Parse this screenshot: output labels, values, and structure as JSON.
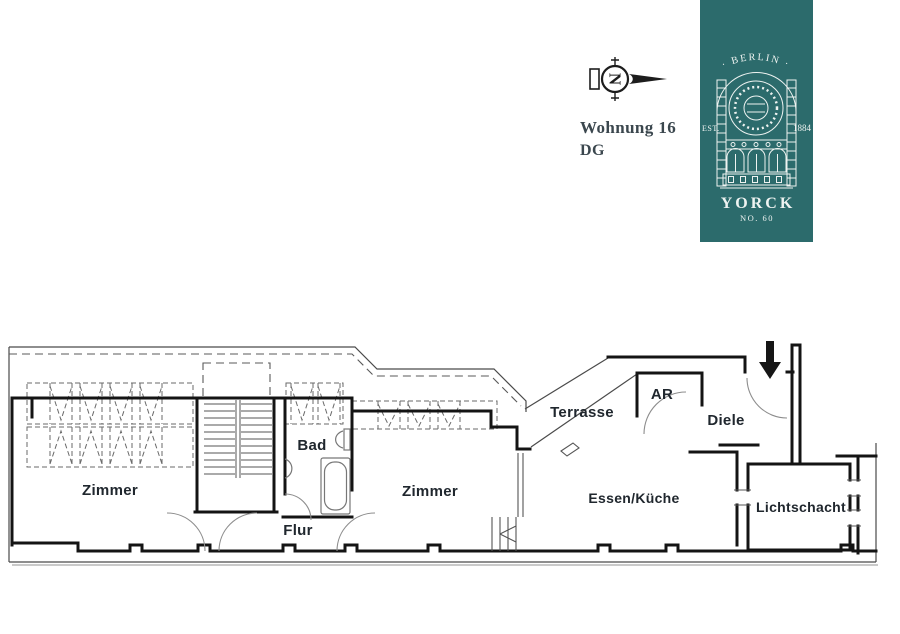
{
  "header": {
    "apartment_label": "Wohnung 16",
    "floor_label": "DG",
    "compass_letter": "N"
  },
  "badge": {
    "city": "· BERLIN ·",
    "est_label": "EST.",
    "year": "1884",
    "house_name": "YORCK",
    "house_number": "NO. 60",
    "background_color": "#2c6b6c",
    "foreground_color": "#eef3f1"
  },
  "floorplan": {
    "wall_color": "#141414",
    "line_color": "#4a4a4a",
    "rooms": [
      {
        "id": "zimmer-1",
        "label": "Zimmer"
      },
      {
        "id": "bad",
        "label": "Bad"
      },
      {
        "id": "flur",
        "label": "Flur"
      },
      {
        "id": "zimmer-2",
        "label": "Zimmer"
      },
      {
        "id": "terrasse",
        "label": "Terrasse"
      },
      {
        "id": "abstellraum",
        "label": "AR"
      },
      {
        "id": "diele",
        "label": "Diele"
      },
      {
        "id": "essen-kueche",
        "label": "Essen/Küche"
      },
      {
        "id": "lichtschacht",
        "label": "Lichtschacht"
      }
    ]
  }
}
